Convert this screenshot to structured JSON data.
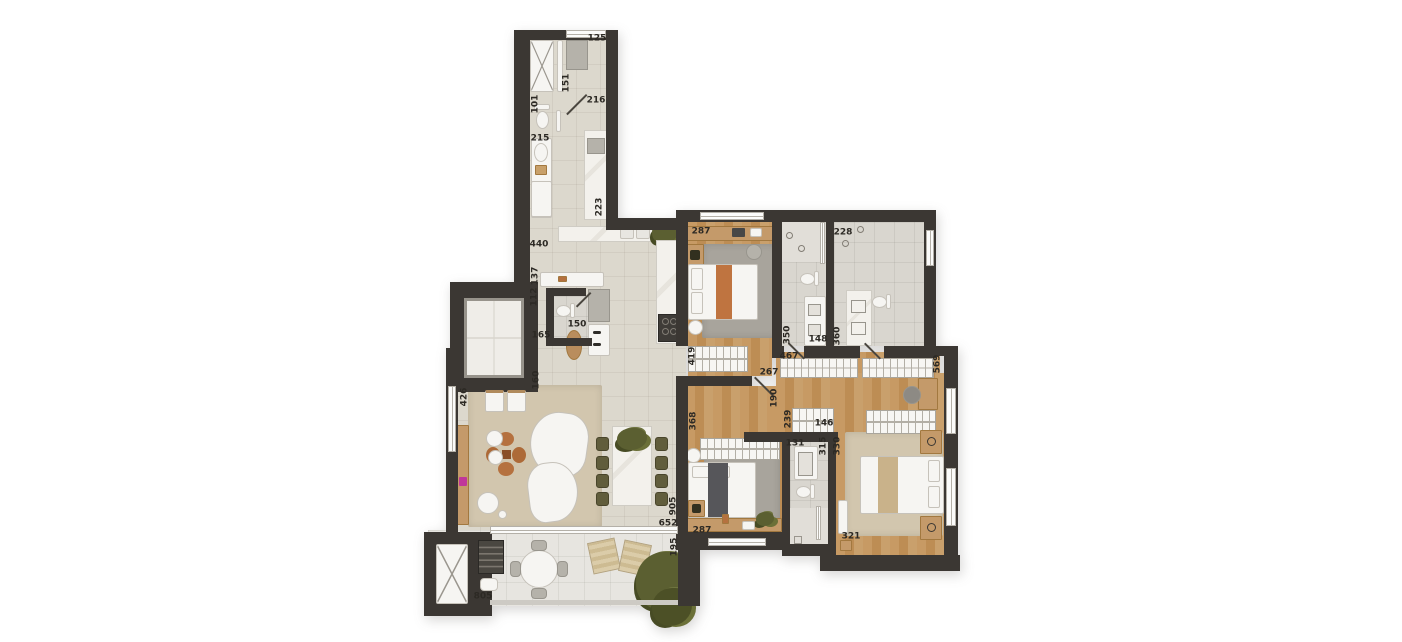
{
  "floorplan": {
    "description_labels_unit": "cm",
    "dimension_labels": [
      {
        "text": "125",
        "x": 597,
        "y": 39,
        "orientation": "h"
      },
      {
        "text": "151",
        "x": 567,
        "y": 83,
        "orientation": "v"
      },
      {
        "text": "101",
        "x": 536,
        "y": 104,
        "orientation": "v"
      },
      {
        "text": "216",
        "x": 596,
        "y": 101,
        "orientation": "h"
      },
      {
        "text": "215",
        "x": 540,
        "y": 139,
        "orientation": "h"
      },
      {
        "text": "223",
        "x": 600,
        "y": 207,
        "orientation": "v"
      },
      {
        "text": "440",
        "x": 539,
        "y": 245,
        "orientation": "h"
      },
      {
        "text": "137",
        "x": 536,
        "y": 276,
        "orientation": "v"
      },
      {
        "text": "112",
        "x": 535,
        "y": 297,
        "orientation": "v"
      },
      {
        "text": "150",
        "x": 577,
        "y": 325,
        "orientation": "h"
      },
      {
        "text": "165",
        "x": 541,
        "y": 336,
        "orientation": "h"
      },
      {
        "text": "160",
        "x": 537,
        "y": 380,
        "orientation": "v"
      },
      {
        "text": "426",
        "x": 465,
        "y": 397,
        "orientation": "v"
      },
      {
        "text": "287",
        "x": 701,
        "y": 232,
        "orientation": "h"
      },
      {
        "text": "228",
        "x": 843,
        "y": 233,
        "orientation": "h"
      },
      {
        "text": "419",
        "x": 693,
        "y": 356,
        "orientation": "v"
      },
      {
        "text": "350",
        "x": 788,
        "y": 335,
        "orientation": "v"
      },
      {
        "text": "148",
        "x": 818,
        "y": 340,
        "orientation": "h"
      },
      {
        "text": "360",
        "x": 838,
        "y": 336,
        "orientation": "v"
      },
      {
        "text": "467",
        "x": 789,
        "y": 357,
        "orientation": "h"
      },
      {
        "text": "569",
        "x": 938,
        "y": 364,
        "orientation": "v"
      },
      {
        "text": "267",
        "x": 769,
        "y": 373,
        "orientation": "h"
      },
      {
        "text": "190",
        "x": 775,
        "y": 398,
        "orientation": "v"
      },
      {
        "text": "239",
        "x": 789,
        "y": 419,
        "orientation": "v"
      },
      {
        "text": "146",
        "x": 824,
        "y": 424,
        "orientation": "h"
      },
      {
        "text": "131",
        "x": 795,
        "y": 444,
        "orientation": "h"
      },
      {
        "text": "315",
        "x": 824,
        "y": 446,
        "orientation": "v"
      },
      {
        "text": "330",
        "x": 838,
        "y": 446,
        "orientation": "v"
      },
      {
        "text": "368",
        "x": 694,
        "y": 421,
        "orientation": "v"
      },
      {
        "text": "905",
        "x": 674,
        "y": 506,
        "orientation": "v"
      },
      {
        "text": "652",
        "x": 668,
        "y": 524,
        "orientation": "h"
      },
      {
        "text": "195",
        "x": 675,
        "y": 547,
        "orientation": "v"
      },
      {
        "text": "287",
        "x": 702,
        "y": 531,
        "orientation": "h"
      },
      {
        "text": "321",
        "x": 851,
        "y": 537,
        "orientation": "h"
      },
      {
        "text": "805",
        "x": 483,
        "y": 597,
        "orientation": "h"
      }
    ],
    "palette": {
      "wall": "#3b3733",
      "tile_floor": "#dcd8cd",
      "wood_floor": "#c49a66",
      "bath_floor": "#d9d6cf",
      "balcony_floor": "#e7e5e0",
      "rug_gray": "#a8a49c",
      "rug_beige": "#d2c6ae",
      "furniture_white": "#f6f5f2",
      "marble": "#f1efe9",
      "wood_furniture": "#c49a6a",
      "olive_chair": "#615d3c",
      "bed_runner_orange": "#bf7440",
      "bed_runner_dark": "#56565a",
      "bed_runner_tan": "#c9b28a",
      "plant_green": "#5b5f31",
      "accent_pink": "#c0369a"
    }
  }
}
